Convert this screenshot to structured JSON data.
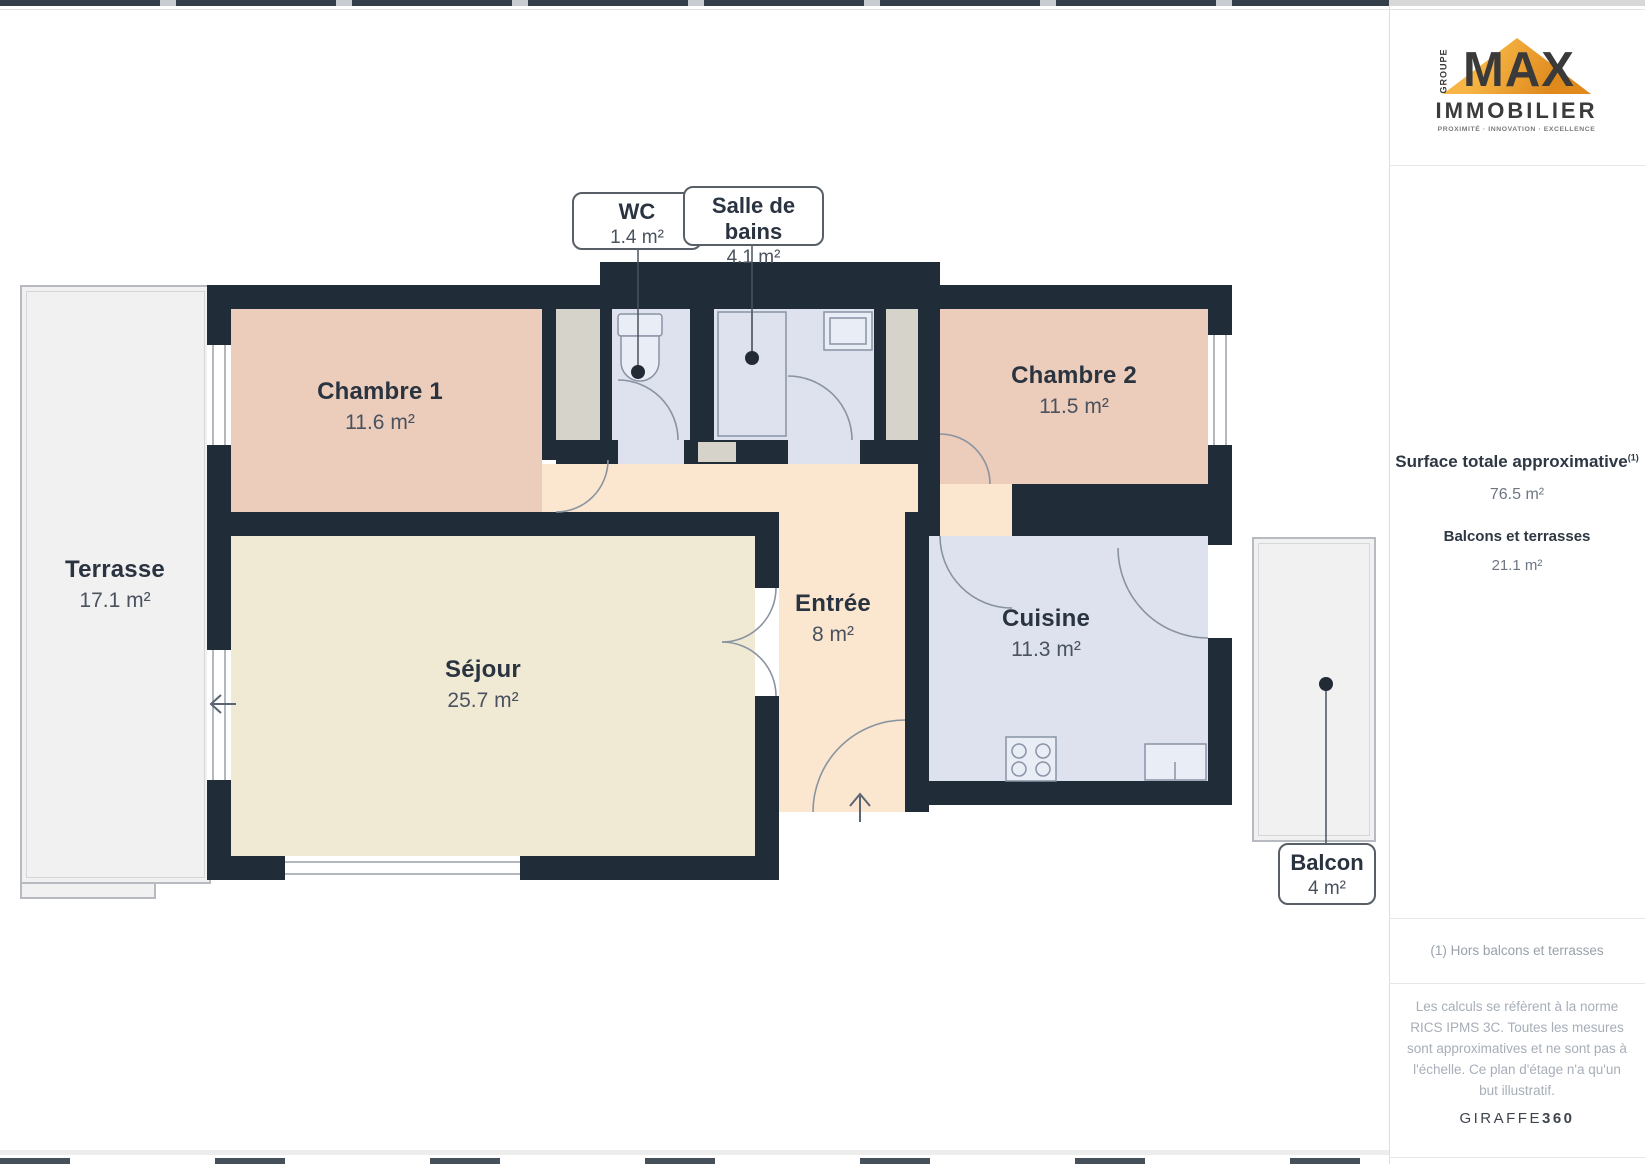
{
  "plan": {
    "rooms": [
      {
        "name": "Chambre 1",
        "area": "11.6 m²"
      },
      {
        "name": "Chambre 2",
        "area": "11.5 m²"
      },
      {
        "name": "Séjour",
        "area": "25.7 m²"
      },
      {
        "name": "Entrée",
        "area": "8 m²"
      },
      {
        "name": "Cuisine",
        "area": "11.3 m²"
      },
      {
        "name": "Terrasse",
        "area": "17.1 m²"
      }
    ],
    "callouts": [
      {
        "name": "WC",
        "area": "1.4 m²"
      },
      {
        "name": "Salle de bains",
        "area": "4.1 m²"
      },
      {
        "name": "Balcon",
        "area": "4 m²"
      }
    ]
  },
  "sidebar": {
    "surface_title": "Surface totale approximative",
    "surface_note_marker": "(1)",
    "surface_value": "76.5 m²",
    "balconies_title": "Balcons et terrasses",
    "balconies_value": "21.1 m²",
    "footnote": "(1) Hors balcons et terrasses",
    "disclaimer": "Les calculs se réfèrent à la norme RICS IPMS 3C. Toutes les mesures sont approximatives et ne sont pas à l'échelle. Ce plan d'étage n'a qu'un but illustratif.",
    "brand_light": "GIRAFFE",
    "brand_bold": "360"
  },
  "logo": {
    "groupe": "GROUPE",
    "max": "MAX",
    "immobilier": "IMMOBILIER",
    "tagline": "PROXIMITÉ · INNOVATION · EXCELLENCE"
  },
  "colors": {
    "wall": "#212c39",
    "bedroom_floor": "#ecccba",
    "living_floor": "#f0ead5",
    "hall_floor": "#fbe7cf",
    "wet_room_floor": "#dde2ee",
    "closet_floor": "#d6d3ca",
    "outdoor_floor": "#f1f1f1",
    "logo_accent": "#e9961f"
  }
}
